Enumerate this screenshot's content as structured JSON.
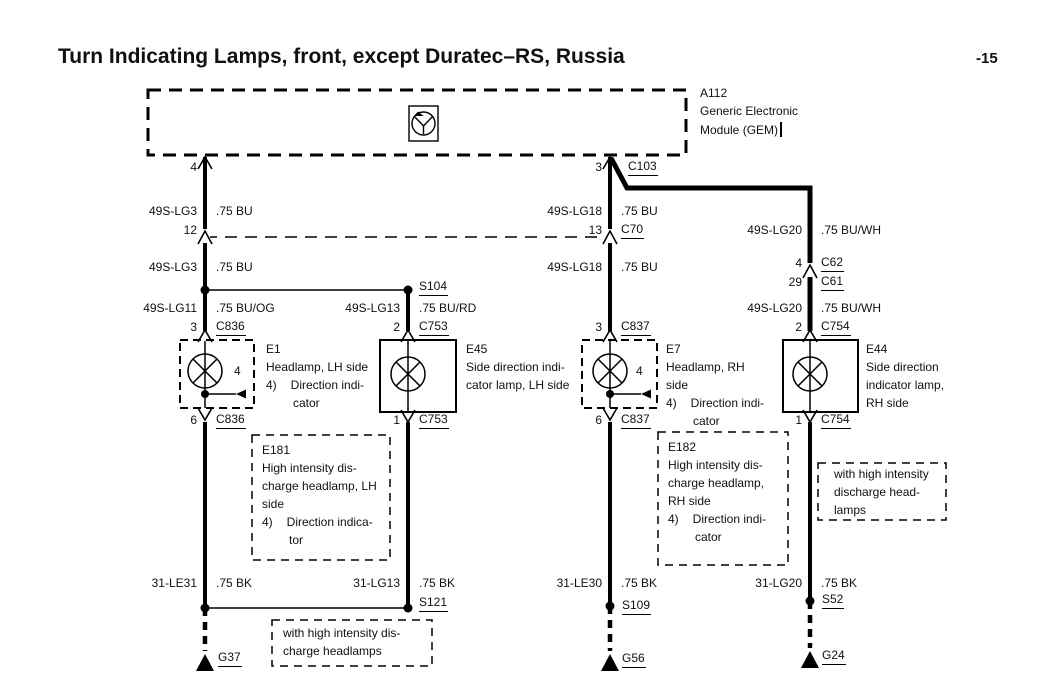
{
  "title": "Turn Indicating Lamps, front, except Duratec–RS, Russia",
  "page_number": "-15",
  "colors": {
    "ink": "#000000",
    "paper": "#ffffff"
  },
  "gem": {
    "id": "A112",
    "desc1": "Generic Electronic",
    "desc2": "Module (GEM)",
    "pin_left": "4",
    "pin_right": "3",
    "connector": "C103"
  },
  "lh": {
    "w1_circuit": "49S-LG3",
    "w1_spec": ".75 BU",
    "pin_12": "12",
    "w2_circuit": "49S-LG3",
    "w2_spec": ".75 BU",
    "w3_circuit": "49S-LG11",
    "w3_spec": ".75 BU/OG",
    "pin_in": "3",
    "conn_in": "C836",
    "pin_out": "6",
    "conn_out": "C836",
    "w4_circuit": "31-LE31",
    "w4_spec": ".75 BK",
    "ground": "G37"
  },
  "side_lh": {
    "splice_top": "S104",
    "w1_circuit": "49S-LG13",
    "w1_spec": ".75 BU/RD",
    "pin_in": "2",
    "conn_in": "C753",
    "pin_out": "1",
    "conn_out": "C753",
    "w2_circuit": "31-LG13",
    "w2_spec": ".75 BK",
    "splice_bottom": "S121"
  },
  "rh": {
    "w1_circuit": "49S-LG18",
    "w1_spec": ".75 BU",
    "pin_13": "13",
    "conn_13": "C70",
    "w2_circuit": "49S-LG18",
    "w2_spec": ".75 BU",
    "pin_in": "3",
    "conn_in": "C837",
    "pin_out": "6",
    "conn_out": "C837",
    "w3_circuit": "31-LE30",
    "w3_spec": ".75 BK",
    "splice": "S109",
    "ground": "G56"
  },
  "side_rh": {
    "w1_circuit": "49S-LG20",
    "w1_spec": ".75 BU/WH",
    "pin_c62": "4",
    "conn_c62": "C62",
    "pin_c61": "29",
    "conn_c61": "C61",
    "w2_circuit": "49S-LG20",
    "w2_spec": ".75 BU/WH",
    "pin_in": "2",
    "conn_in": "C754",
    "pin_out": "1",
    "conn_out": "C754",
    "w3_circuit": "31-LG20",
    "w3_spec": ".75 BK",
    "splice": "S52",
    "ground": "G24"
  },
  "e1": {
    "id": "E1",
    "desc1": "Headlamp, LH side",
    "note_num": "4)",
    "note_l1": "Direction indi-",
    "note_l2": "cator",
    "pin": "4"
  },
  "e45": {
    "id": "E45",
    "desc1": "Side direction indi-",
    "desc2": "cator lamp, LH side"
  },
  "e7": {
    "id": "E7",
    "desc1": "Headlamp, RH",
    "desc2": "side",
    "note_num": "4)",
    "note_l1": "Direction indi-",
    "note_l2": "cator",
    "pin": "4"
  },
  "e44": {
    "id": "E44",
    "desc1": "Side direction",
    "desc2": "indicator lamp,",
    "desc3": "RH side"
  },
  "e181": {
    "id": "E181",
    "l1": "High intensity dis-",
    "l2": "charge headlamp, LH",
    "l3": "side",
    "note_num": "4)",
    "note_l1": "Direction indica-",
    "note_l2": "tor"
  },
  "e182": {
    "id": "E182",
    "l1": "High intensity dis-",
    "l2": "charge headlamp,",
    "l3": "RH side",
    "note_num": "4)",
    "note_l1": "Direction indi-",
    "note_l2": "cator"
  },
  "hid_note_right": {
    "l1": "with high intensity",
    "l2": "discharge head-",
    "l3": "lamps"
  },
  "hid_note_bottom": {
    "l1": "with high intensity dis-",
    "l2": "charge headlamps"
  }
}
